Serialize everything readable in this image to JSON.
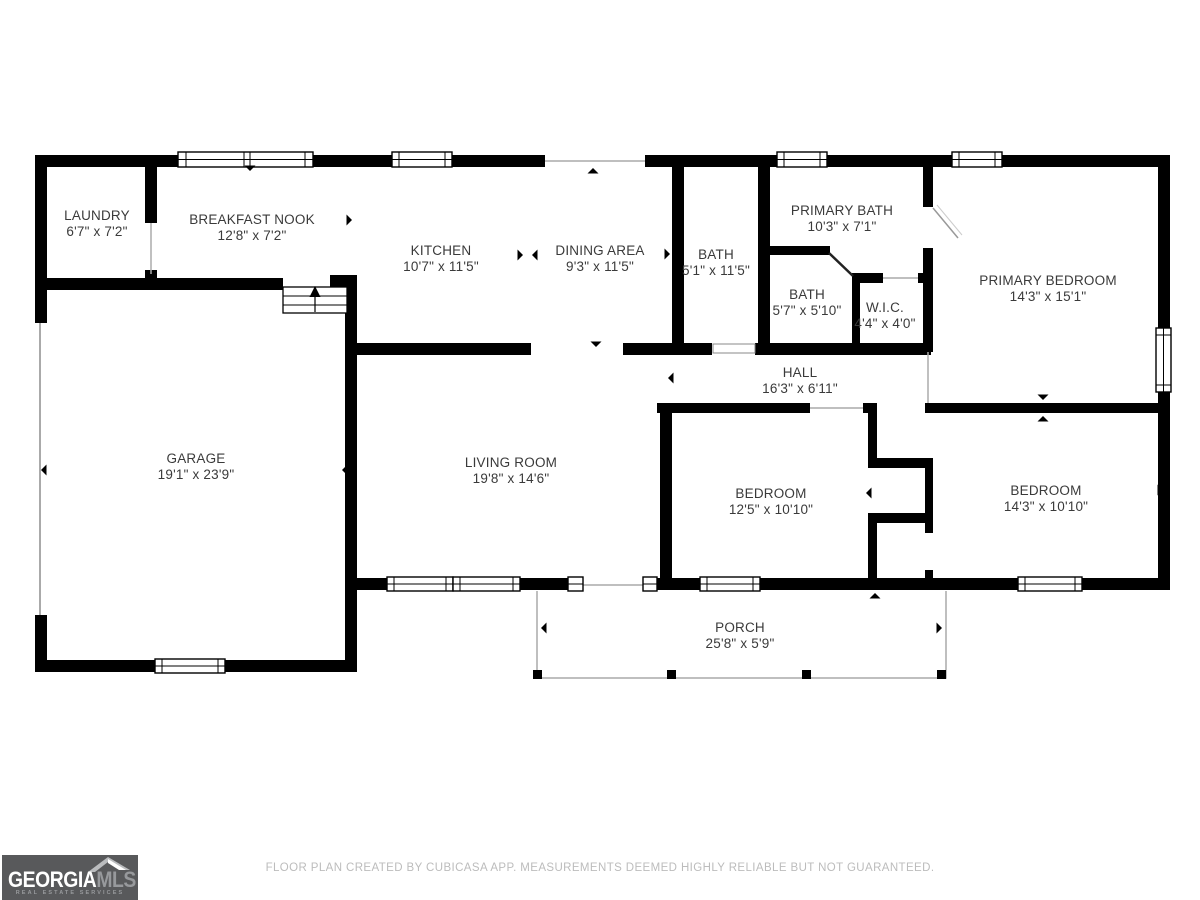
{
  "plan": {
    "rooms": [
      {
        "id": "laundry",
        "name": "LAUNDRY",
        "dims": "6'7\" x 7'2\""
      },
      {
        "id": "breakfast-nook",
        "name": "BREAKFAST NOOK",
        "dims": "12'8\" x 7'2\""
      },
      {
        "id": "kitchen",
        "name": "KITCHEN",
        "dims": "10'7\" x 11'5\""
      },
      {
        "id": "dining-area",
        "name": "DINING AREA",
        "dims": "9'3\" x 11'5\""
      },
      {
        "id": "bath",
        "name": "BATH",
        "dims": "5'1\" x 11'5\""
      },
      {
        "id": "primary-bath",
        "name": "PRIMARY BATH",
        "dims": "10'3\" x 7'1\""
      },
      {
        "id": "bath-2",
        "name": "BATH",
        "dims": "5'7\" x 5'10\""
      },
      {
        "id": "wic",
        "name": "W.I.C.",
        "dims": "4'4\" x 4'0\""
      },
      {
        "id": "primary-bedroom",
        "name": "PRIMARY BEDROOM",
        "dims": "14'3\" x 15'1\""
      },
      {
        "id": "hall",
        "name": "HALL",
        "dims": "16'3\" x 6'11\""
      },
      {
        "id": "garage",
        "name": "GARAGE",
        "dims": "19'1\" x 23'9\""
      },
      {
        "id": "living-room",
        "name": "LIVING ROOM",
        "dims": "19'8\" x 14'6\""
      },
      {
        "id": "bedroom-1",
        "name": "BEDROOM",
        "dims": "12'5\" x 10'10\""
      },
      {
        "id": "bedroom-2",
        "name": "BEDROOM",
        "dims": "14'3\" x 10'10\""
      },
      {
        "id": "porch",
        "name": "PORCH",
        "dims": "25'8\" x 5'9\""
      }
    ],
    "footer": "FLOOR PLAN CREATED BY CUBICASA APP. MEASUREMENTS DEEMED HIGHLY RELIABLE BUT NOT GUARANTEED."
  },
  "logo": {
    "brand_primary": "GEORGIA",
    "brand_secondary": "MLS",
    "tagline": "REAL ESTATE SERVICES"
  },
  "colors": {
    "wall": "#000000",
    "label_text": "#3a3a3a",
    "footer_text": "#bcbcbc",
    "opening_line": "#aaaaaa",
    "logo_background": "#58595b",
    "logo_secondary": "#97999c"
  }
}
